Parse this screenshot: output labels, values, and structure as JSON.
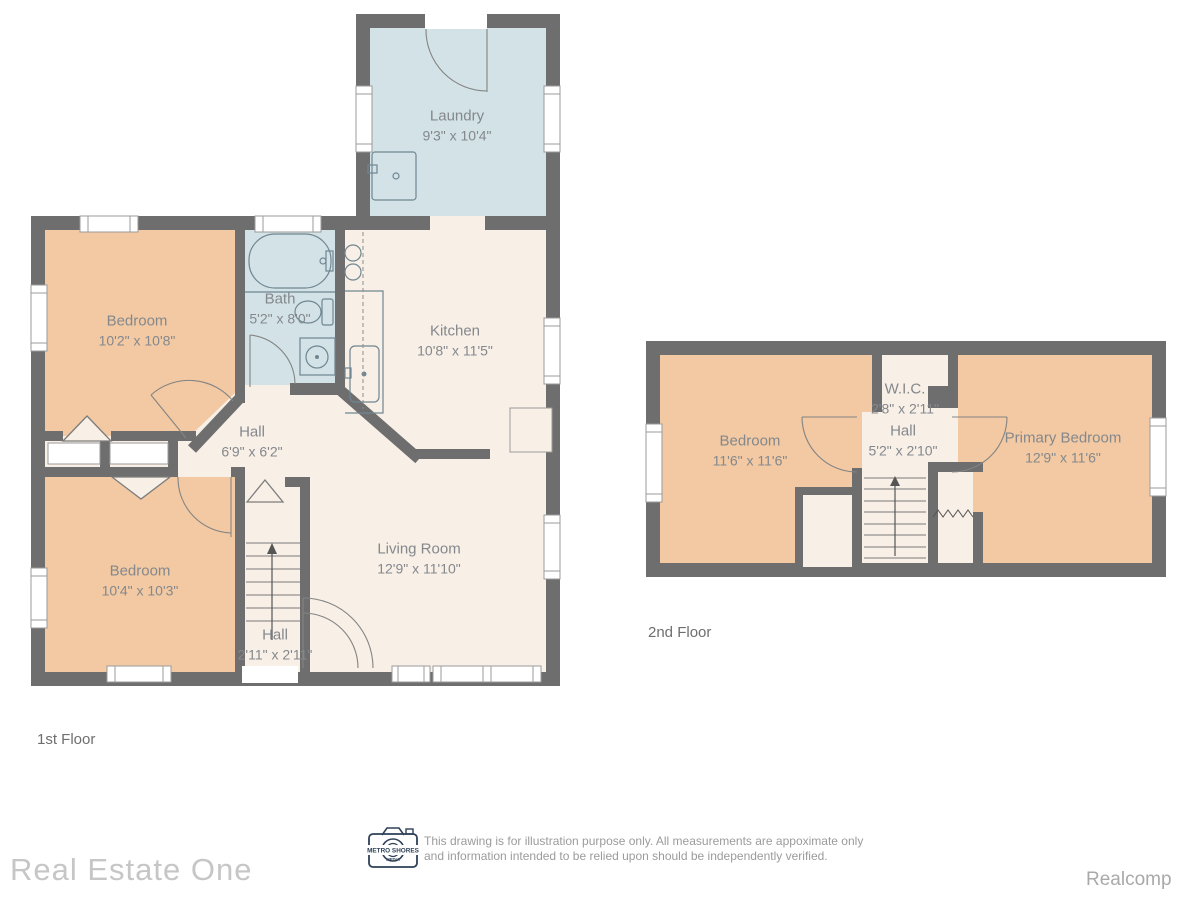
{
  "colors": {
    "wall": "#6e6e6e",
    "bedroom_fill": "#f2c9a2",
    "wet_room_fill": "#d2e2e6",
    "common_fill": "#f8efe7",
    "background": "#ffffff",
    "label_text": "#84888d",
    "logo_navy": "#2e4057"
  },
  "floors": {
    "first": {
      "label": "1st Floor",
      "rooms": {
        "laundry": {
          "name": "Laundry",
          "dims": "9'3\" x 10'4\""
        },
        "bedroom_top": {
          "name": "Bedroom",
          "dims": "10'2\" x 10'8\""
        },
        "bath": {
          "name": "Bath",
          "dims": "5'2\" x 8'0\""
        },
        "kitchen": {
          "name": "Kitchen",
          "dims": "10'8\" x 11'5\""
        },
        "hall": {
          "name": "Hall",
          "dims": "6'9\" x 6'2\""
        },
        "bedroom_bottom": {
          "name": "Bedroom",
          "dims": "10'4\" x 10'3\""
        },
        "living_room": {
          "name": "Living Room",
          "dims": "12'9\" x 11'10\""
        },
        "stair_hall": {
          "name": "Hall",
          "dims": "2'11\" x 2'11\""
        }
      }
    },
    "second": {
      "label": "2nd Floor",
      "rooms": {
        "bedroom": {
          "name": "Bedroom",
          "dims": "11'6\" x 11'6\""
        },
        "wic": {
          "name": "W.I.C.",
          "dims": "2'8\" x 2'11\""
        },
        "hall": {
          "name": "Hall",
          "dims": "5'2\" x 2'10\""
        },
        "primary_bedroom": {
          "name": "Primary Bedroom",
          "dims": "12'9\" x 11'6\""
        }
      }
    }
  },
  "footer": {
    "logo": {
      "line1": "METRO SHORES",
      "line2": "MEDIA"
    },
    "disclaimer_line1": "This drawing is for illustration purpose only.  All measurements are appoximate only",
    "disclaimer_line2": "and information intended to be relied upon should be independently verified."
  },
  "branding": {
    "company_left": "Real Estate One",
    "company_right": "Realcomp"
  }
}
